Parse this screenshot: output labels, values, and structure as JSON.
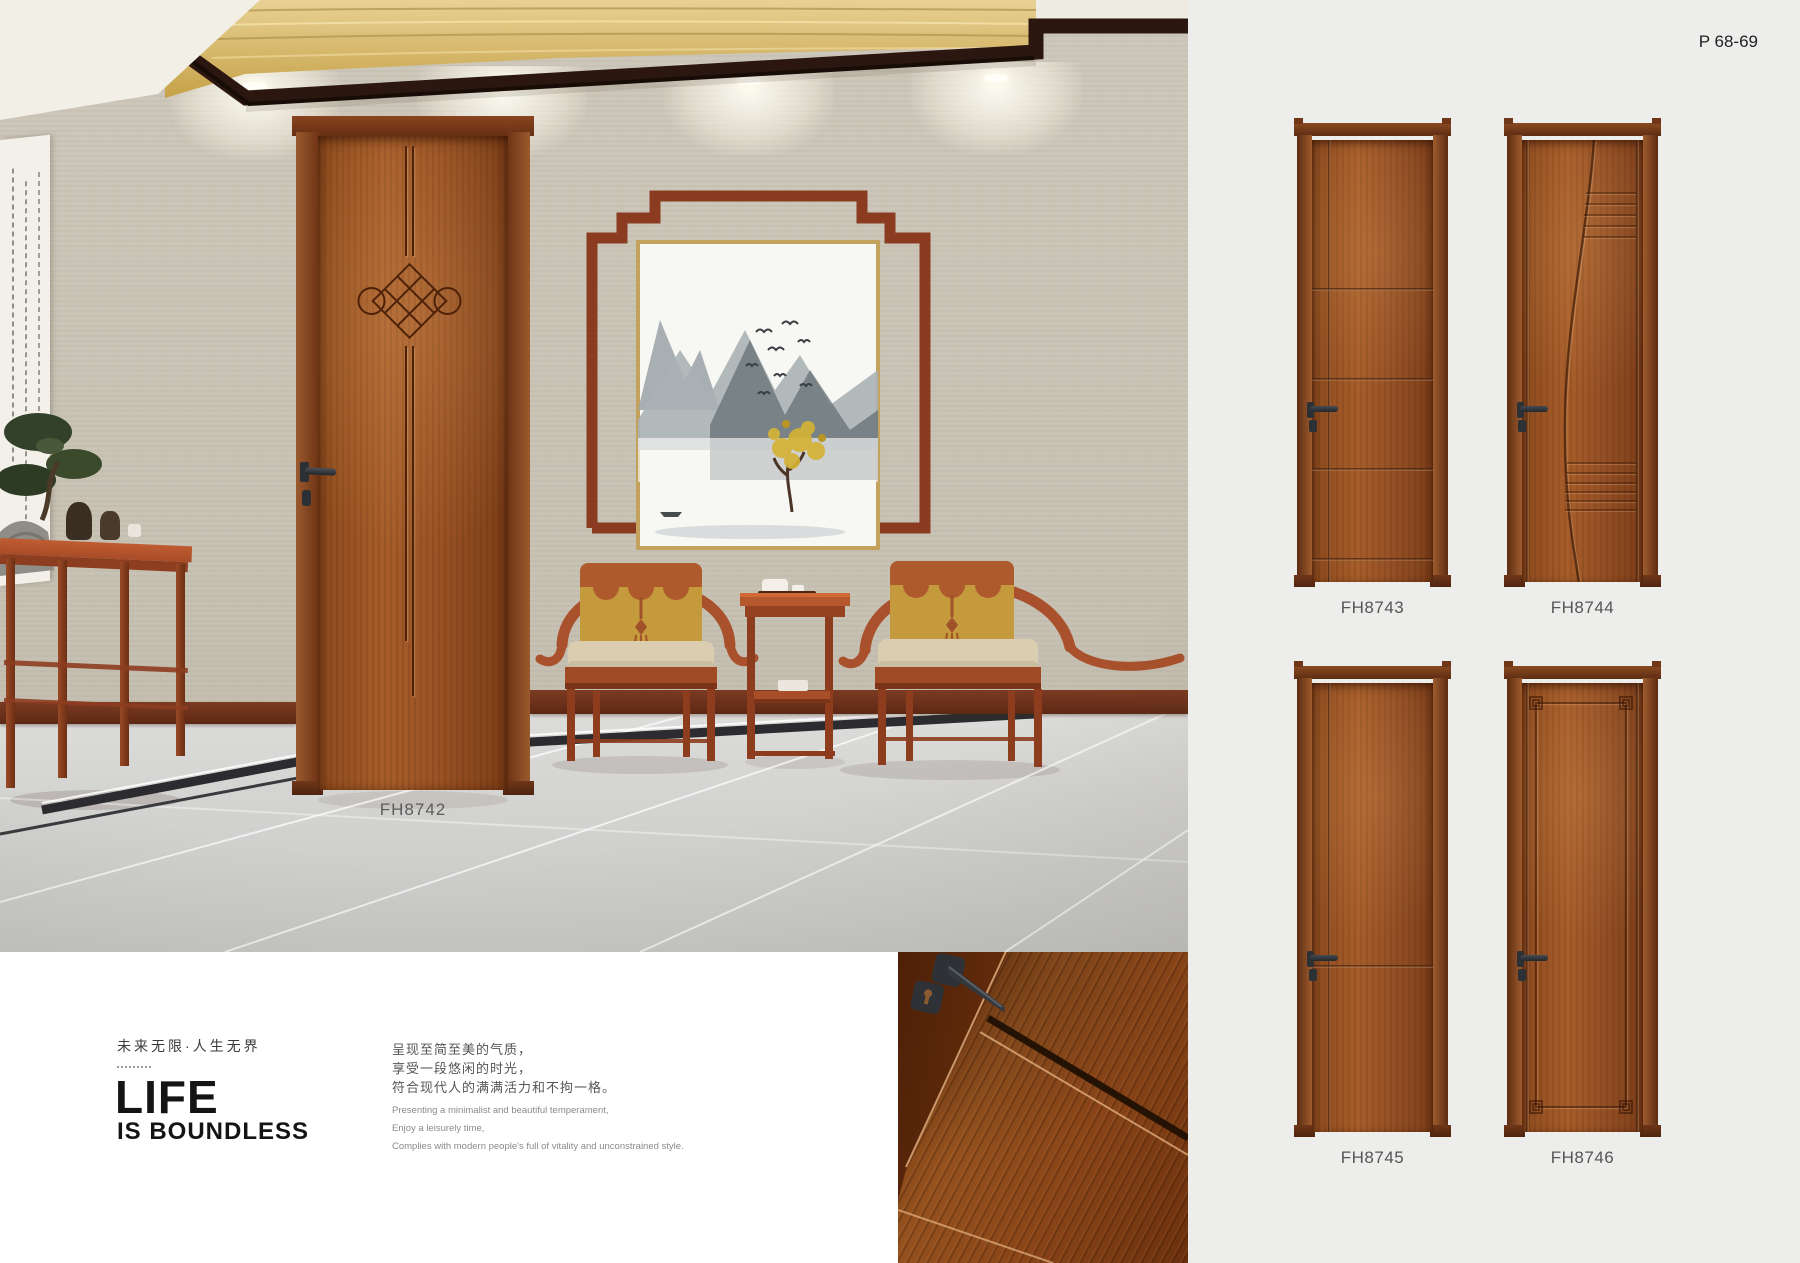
{
  "page": {
    "number": "P 68-69"
  },
  "scene": {
    "door_label": "FH8742"
  },
  "intro": {
    "tagline_zh": "未来无限·人生无界",
    "title": "LIFE",
    "subtitle": "IS BOUNDLESS",
    "desc_zh": [
      "呈现至简至美的气质，",
      "享受一段悠闲的时光，",
      "符合现代人的满满活力和不拘一格。"
    ],
    "desc_en": [
      "Presenting a minimalist and beautiful temperament,",
      "Enjoy a leisurely time,",
      "Complies with modern people's full of vitality and unconstrained style."
    ]
  },
  "products": [
    {
      "code": "FH8743"
    },
    {
      "code": "FH8744"
    },
    {
      "code": "FH8745"
    },
    {
      "code": "FH8746"
    }
  ],
  "colors": {
    "panel_bg": "#edeeec",
    "door_wood": "#9a5526",
    "door_frame": "#5f2e14",
    "accent_red": "#a8512c",
    "gold_cove": "#d9b95c",
    "label_gray": "#555555"
  }
}
